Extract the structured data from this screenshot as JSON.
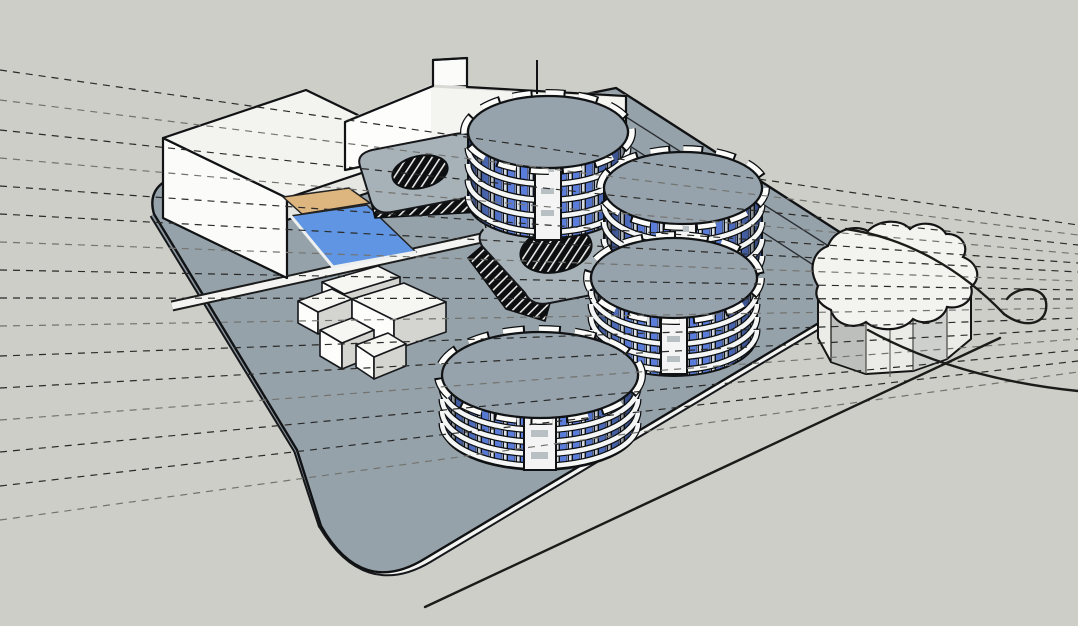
{
  "viewport": {
    "kind": "3d-architectural-massing-model",
    "style": "monochrome sketch render with dashed site guide lines",
    "visible_text": "none",
    "width": 1078,
    "height": 626
  },
  "palette": {
    "background": "#cdcec8",
    "deck": "#96a2aa",
    "deck_side": "#8b959d",
    "podium": "#a7b1b8",
    "roof": "#97a3ac",
    "white_face": "#fbfbf9",
    "white_top": "#f3f3f0",
    "white_shade": "#e6e6e2",
    "window_blue": "#5a7ddb",
    "window_blue_light": "#9db1e6",
    "facade_dark": "#0e1218",
    "pool_water": "#5f95e2",
    "pool_apron": "#ddb57e",
    "outline": "#101214",
    "fascia": "#f4f5f3",
    "guide_dark": "#2a2a28",
    "guide_light": "#73736f",
    "hatch_bg": "#0c0e10",
    "cloud_side": "#ebebe7",
    "cloud_facet": "#bcbfbb"
  },
  "scene": {
    "site_deck": {
      "shape": "large rounded slab viewed in perspective",
      "levels": [
        "ground deck",
        "raised podium with courtyard openings"
      ],
      "courtyard_openings": {
        "count": 2,
        "shape": "rounded oval",
        "treatment": "dark hatched void"
      },
      "edge_treatment": "white fascia band along front edges"
    },
    "round_towers": {
      "count": 4,
      "locations": [
        "north",
        "northeast",
        "east",
        "south-center"
      ],
      "floor_bands_each": 4,
      "facade": "alternating blue glazing strips and white balcony bands",
      "core": "central white stair tower",
      "roof": "flat grey drum roof with scalloped white parapet tabs"
    },
    "white_buildings": {
      "slab_building_west": {
        "form": "large rectangular slab block"
      },
      "bar_building_north": {
        "form": "long bent bar with rooftop notch and thin pole"
      },
      "pavilion_cluster_center": {
        "form": "low interlocking blocks",
        "block_count": 5
      },
      "cloud_plan_building_east": {
        "form": "scalloped blob-plan block with faceted sides"
      }
    },
    "pool": {
      "count": 1,
      "water": "blue rectangle",
      "apron": "tan strip on north side"
    },
    "guide_lines": {
      "count": 16,
      "style": "dashed",
      "direction": "fanning from left edge, converging right"
    },
    "roads": {
      "count": 4,
      "style": "solid black diagonals and a looping curve near the cloud building"
    }
  }
}
